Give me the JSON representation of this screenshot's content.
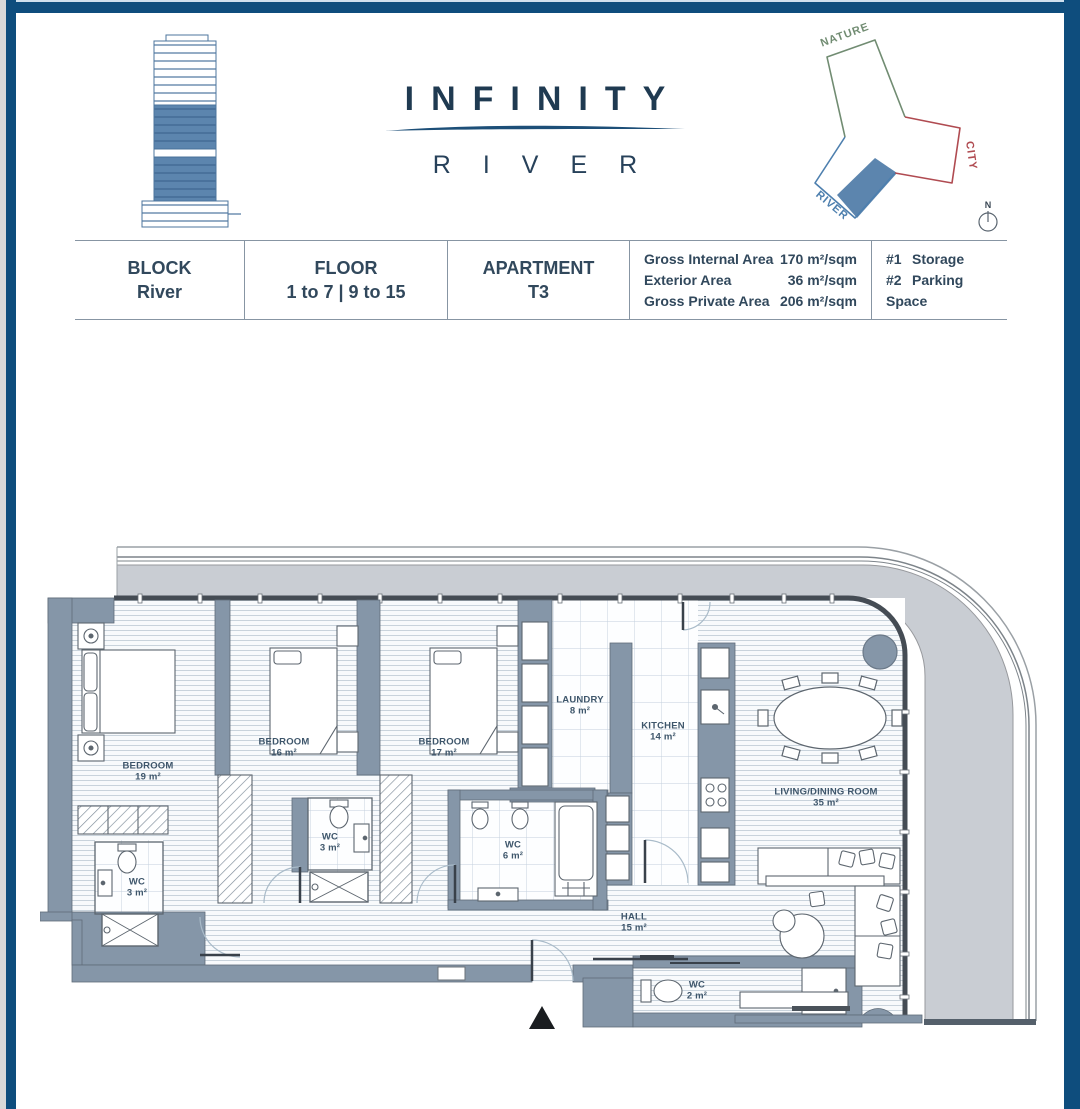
{
  "header": {
    "title": "INFINITY",
    "subtitle": "RIVER",
    "diagram": {
      "nature": "NATURE",
      "city": "CITY",
      "river": "RIVER",
      "compass": "N"
    }
  },
  "table": {
    "block": {
      "label": "BLOCK",
      "value": "River"
    },
    "floor": {
      "label": "FLOOR",
      "value": "1 to 7 | 9 to 15"
    },
    "apartment": {
      "label": "APARTMENT",
      "value": "T3"
    },
    "areas": [
      {
        "label": "Gross Internal Area",
        "value": "170 m²/sqm"
      },
      {
        "label": "Exterior Area",
        "value": "36 m²/sqm"
      },
      {
        "label": "Gross Private Area",
        "value": "206 m²/sqm"
      }
    ],
    "extras": [
      {
        "number": "#1",
        "label": "Storage"
      },
      {
        "number": "#2",
        "label": "Parking Space"
      }
    ]
  },
  "plan": {
    "rooms": [
      {
        "name": "BEDROOM",
        "area": "19 m²"
      },
      {
        "name": "BEDROOM",
        "area": "16 m²"
      },
      {
        "name": "BEDROOM",
        "area": "17 m²"
      },
      {
        "name": "LAUNDRY",
        "area": "8 m²"
      },
      {
        "name": "KITCHEN",
        "area": "14 m²"
      },
      {
        "name": "LIVING/DINING ROOM",
        "area": "35 m²"
      },
      {
        "name": "WC",
        "area": "3 m²"
      },
      {
        "name": "WC",
        "area": "3 m²"
      },
      {
        "name": "WC",
        "area": "6 m²"
      },
      {
        "name": "HALL",
        "area": "15 m²"
      },
      {
        "name": "WC",
        "area": "2 m²"
      }
    ]
  },
  "colors": {
    "frame_navy": "#0e4d7d",
    "title_navy": "#1f3a51",
    "wall_slate": "#8596a8",
    "terrace_gray": "#c9cdd3",
    "diagram_green": "#718c72",
    "diagram_red": "#b04b51",
    "diagram_blue": "#4d7fae",
    "highlight_blue": "#5c85ae"
  }
}
